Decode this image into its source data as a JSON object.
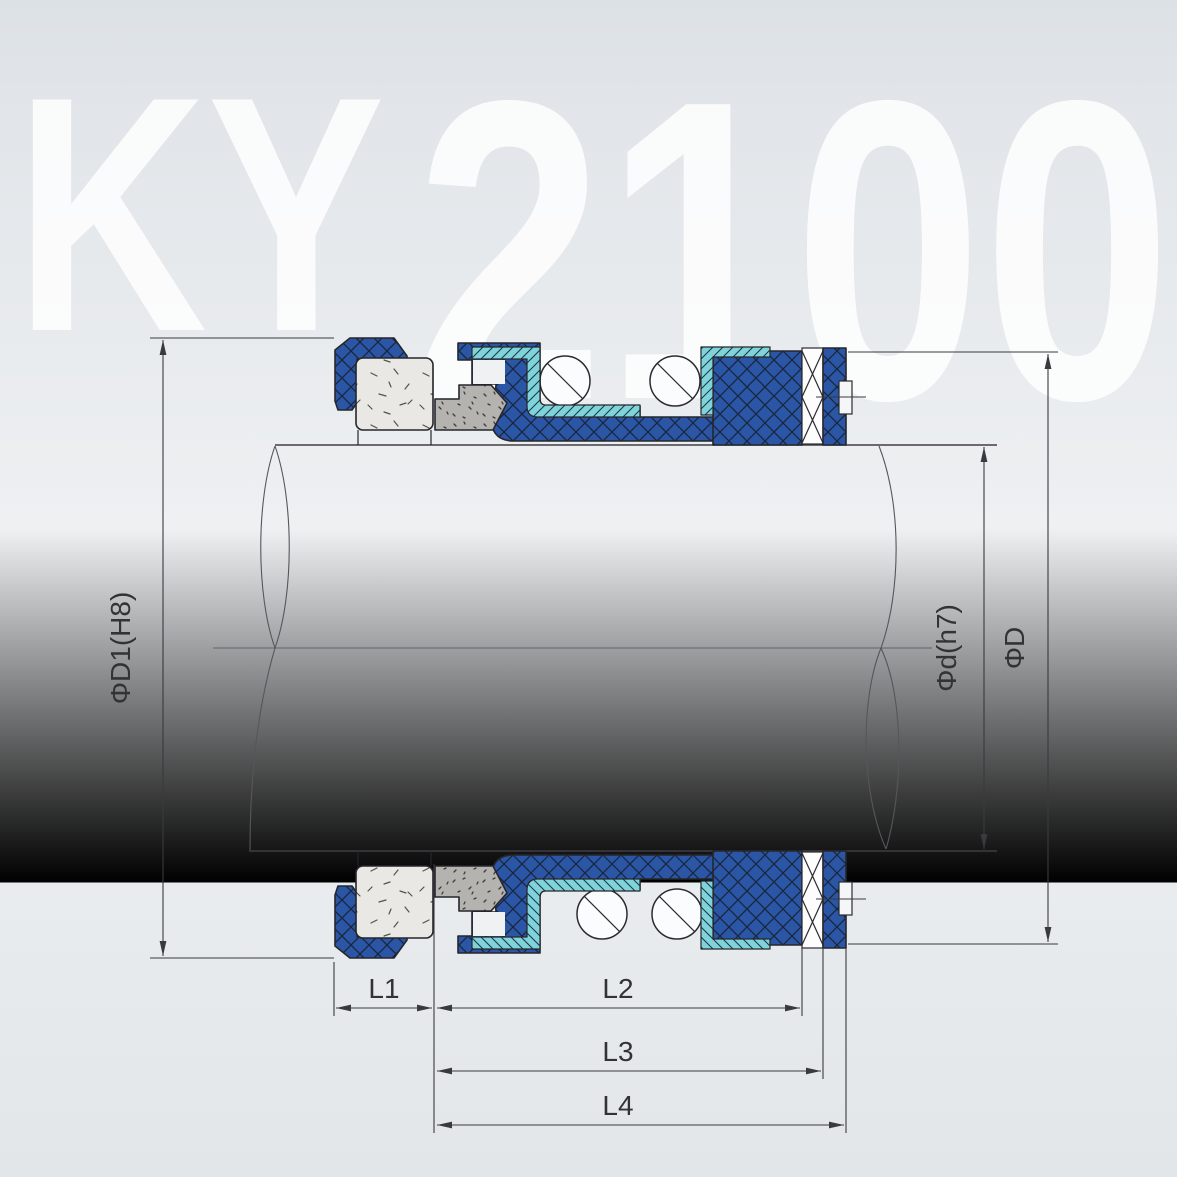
{
  "watermark": {
    "letters": "KY",
    "digits": "2100",
    "full_model": "KY2100"
  },
  "dimension_labels": {
    "bore": "ΦD1(H8)",
    "shaft": "Φd(h7)",
    "outer": "ΦD",
    "l1": "L1",
    "l2": "L2",
    "l3": "L3",
    "l4": "L4"
  },
  "colors": {
    "part_blue": "#2b56a5",
    "hatch_dark": "#18263e",
    "liner_cyan": "#7fd4d9",
    "seat_gray": "#e9e8e5",
    "face_gray": "#b4b3af",
    "outline": "#26262b",
    "dimension_line": "#3a3a3e",
    "background_top": "#dfe3e7",
    "background_mid": "#eef0f2",
    "watermark_white": "#ffffff"
  }
}
